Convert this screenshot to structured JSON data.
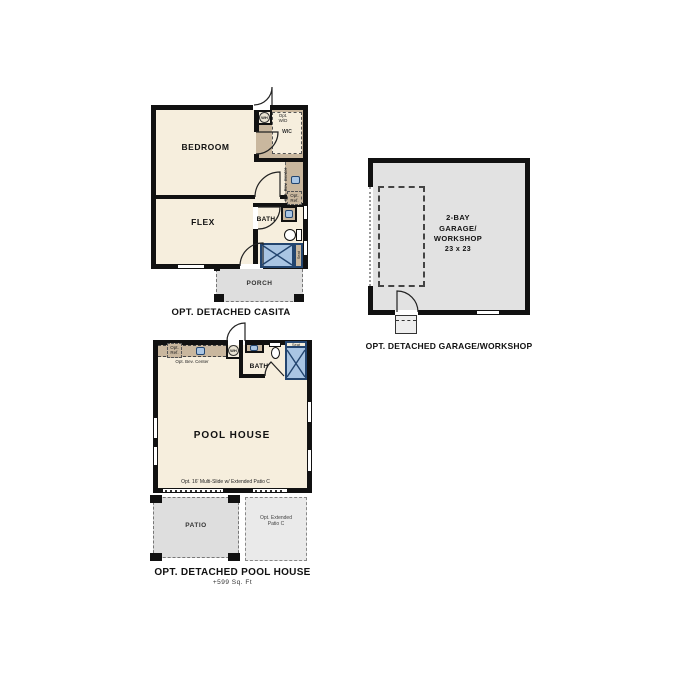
{
  "colors": {
    "wall": "#111111",
    "cream": "#f6eedd",
    "tan": "#c9b79e",
    "gray": "#dedede",
    "gray-light": "#eaeaea",
    "garage-gray": "#e2e2e2",
    "blue": "#a9c5e3",
    "blue-dark": "#23456f"
  },
  "casita": {
    "title": "OPT. DETACHED CASITA",
    "bedroom": "BEDROOM",
    "flex": "FLEX",
    "bath": "BATH",
    "wic": "WIC",
    "porch": "PORCH",
    "wh": "WH",
    "opt_wd_1": "Opt.",
    "opt_wd_2": "W/D",
    "opt_bev": "Opt. Bev. Center",
    "opt_ref_1": "Opt.",
    "opt_ref_2": "Ref.",
    "seat": "Seat"
  },
  "garage": {
    "title": "OPT. DETACHED GARAGE/WORKSHOP",
    "room_lines": [
      "2-BAY",
      "GARAGE/",
      "WORKSHOP",
      "23 x 23"
    ]
  },
  "pool": {
    "title": "OPT. DETACHED POOL HOUSE",
    "subtitle": "+599 Sq. Ft",
    "room": "POOL HOUSE",
    "bath": "BATH",
    "wh": "WH",
    "opt_bev": "Opt. Bev. Center",
    "opt_ref_1": "Opt.",
    "opt_ref_2": "Ref.",
    "seat": "Seat",
    "patio": "PATIO",
    "ext_patio_1": "Opt. Extended",
    "ext_patio_2": "Patio C",
    "multislide": "Opt. 16' Multi-Slide w/ Extended Patio C"
  }
}
